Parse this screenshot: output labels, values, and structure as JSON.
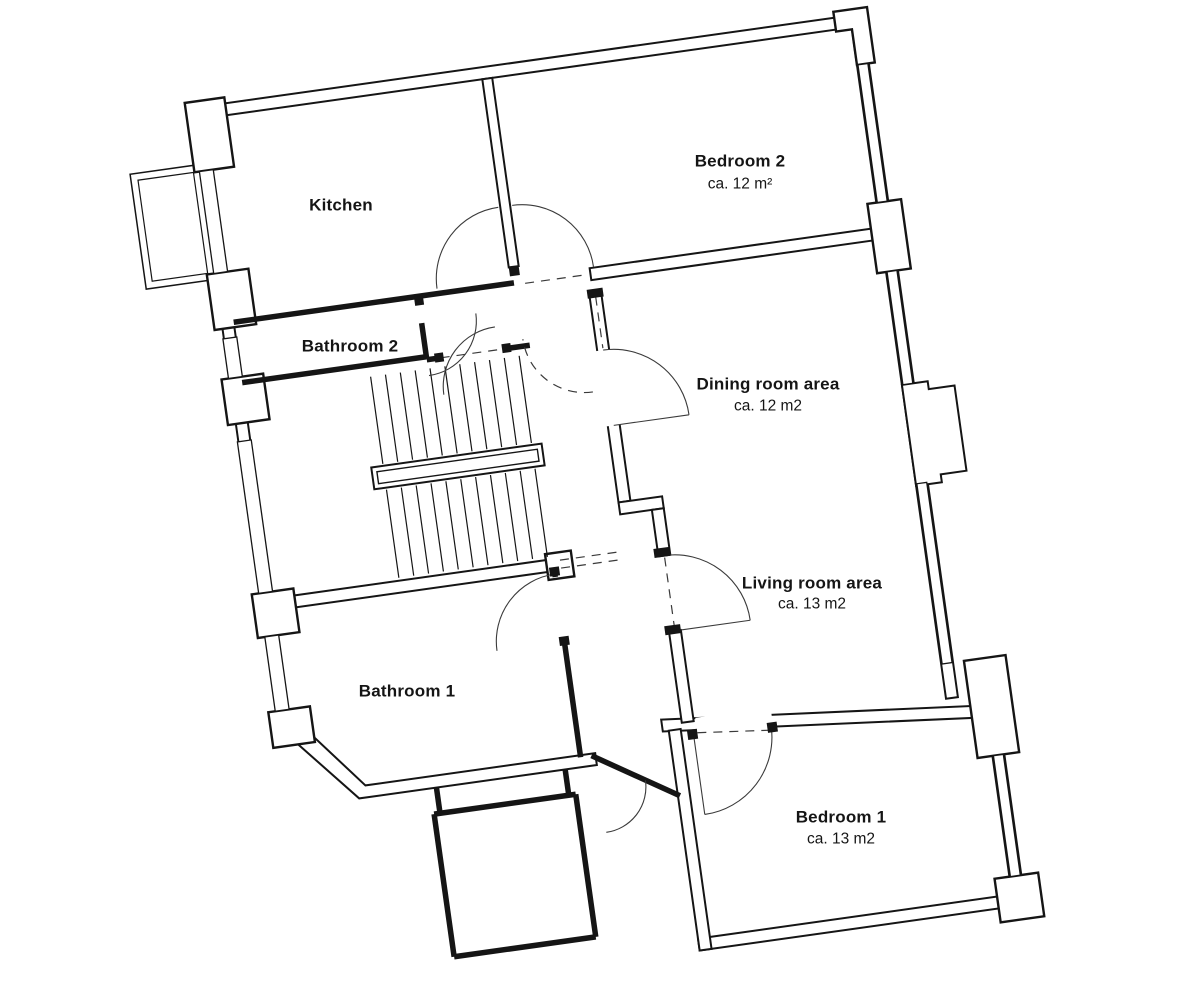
{
  "plan": {
    "type": "apartment-floor-plan",
    "rotation_deg": -8,
    "colors": {
      "line": "#151515",
      "background": "#ffffff"
    }
  },
  "rooms": {
    "kitchen": {
      "name": "Kitchen"
    },
    "bedroom2": {
      "name": "Bedroom 2",
      "area": "ca. 12 m²"
    },
    "bathroom2": {
      "name": "Bathroom 2"
    },
    "dining": {
      "name": "Dining room area",
      "area": "ca. 12 m2"
    },
    "living": {
      "name": "Living room area",
      "area": "ca. 13 m2"
    },
    "bathroom1": {
      "name": "Bathroom 1"
    },
    "bedroom1": {
      "name": "Bedroom 1",
      "area": "ca. 13 m2"
    }
  }
}
